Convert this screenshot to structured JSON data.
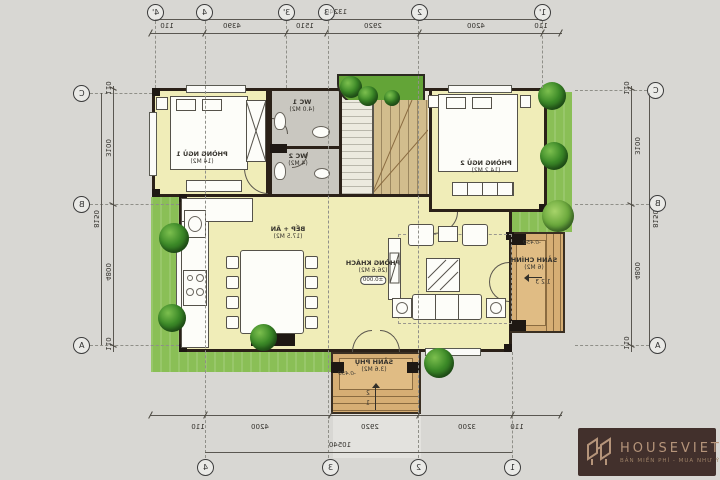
{
  "watermark": {
    "brand": "HOUSEVIET",
    "tagline": "BẢN MIỀN PHÍ - MUA NHƯ Ý"
  },
  "colors": {
    "paper": "#d8d7d3",
    "floor": "#f0edb8",
    "wet_area": "#c9c7c0",
    "porch": "#d6ae74",
    "stair": "#d2bd8d",
    "lawn": "#8abf56",
    "wall": "#2b2118",
    "logo_gold": "#b5947a"
  },
  "grid": {
    "top": [
      "4'",
      "4",
      "3'",
      "3",
      "2",
      "1'"
    ],
    "bottom": [
      "4",
      "3",
      "2",
      "1"
    ],
    "left": [
      "C",
      "B",
      "A"
    ],
    "right": [
      "C",
      "B",
      "A"
    ]
  },
  "dims": {
    "top": [
      "110",
      "4390",
      "1510",
      "2920",
      "4200",
      "110"
    ],
    "top_total": "13240",
    "bottom": [
      "110",
      "4200",
      "2920",
      "3200",
      "110"
    ],
    "bottom_total": "10540",
    "left": [
      "110",
      "3100",
      "4800",
      "110"
    ],
    "left_total": "8150",
    "right": [
      "110",
      "3100",
      "4800",
      "110"
    ],
    "right_total": "8150"
  },
  "rooms": {
    "bedroom1": {
      "name": "PHÒNG NGỦ 1",
      "area": "(14 M2)"
    },
    "wc1": {
      "name": "WC 1",
      "area": "(4.0 M2)"
    },
    "wc2": {
      "name": "WC 2",
      "area": "(4 M2)"
    },
    "bedroom2": {
      "name": "PHÒNG NGỦ 2",
      "area": "(14.2 M2)"
    },
    "kitchen_dining": {
      "name": "BẾP + ĂN",
      "area": "(17.5 M2)"
    },
    "living": {
      "name": "PHÒNG KHÁCH",
      "area": "(26.6 M2)",
      "level": "±0.000"
    },
    "porch_main": {
      "name": "SẢNH CHÍNH",
      "area": "(6 M2)",
      "level": "-0.450",
      "steps": [
        "1 2 3"
      ]
    },
    "porch_side": {
      "name": "SẢNH PHỤ",
      "area": "(3.6 M2)",
      "level": "-0.450",
      "steps": [
        "2",
        "1"
      ]
    }
  }
}
